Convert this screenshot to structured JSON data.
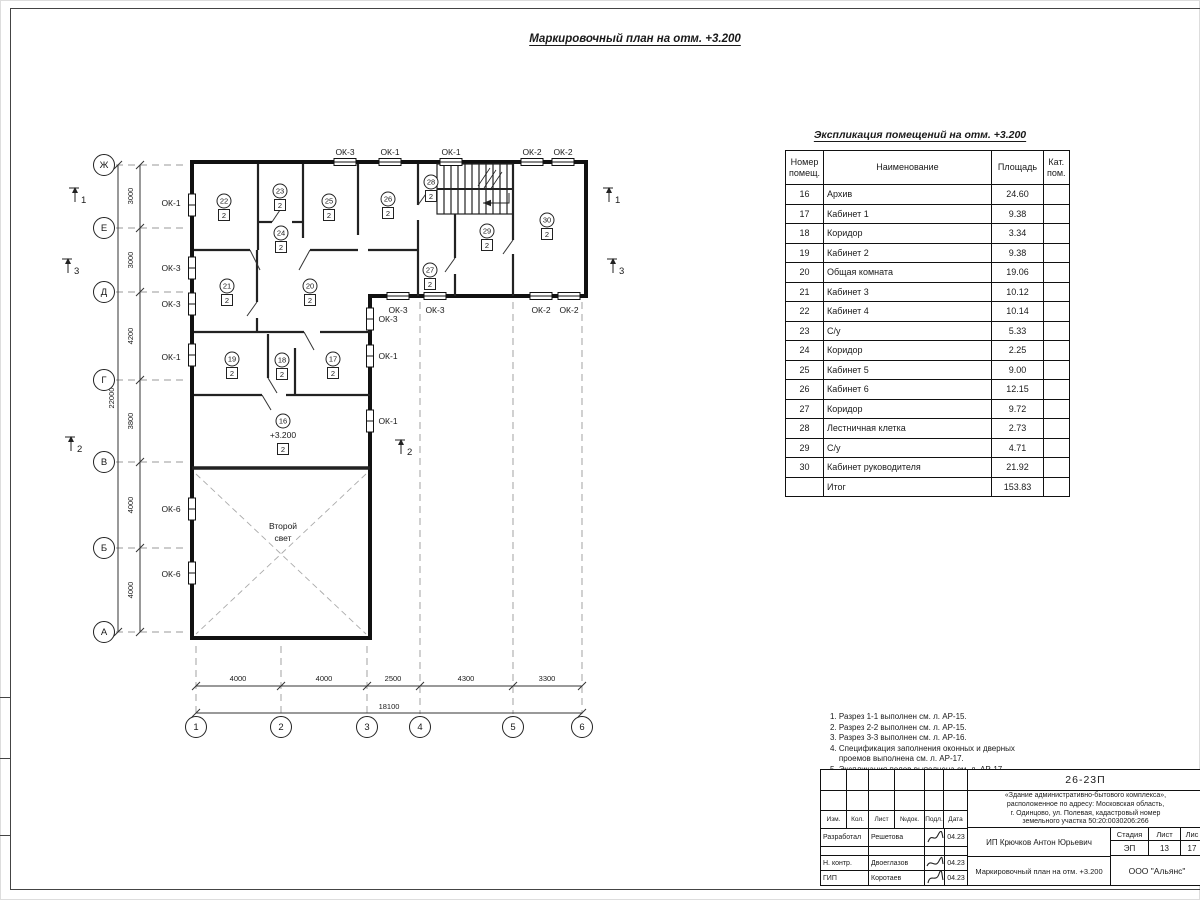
{
  "page": {
    "plan_title": "Маркировочный план на отм. +3.200",
    "table_title": "Экспликация помещений на отм. +3.200"
  },
  "explication": {
    "headers": [
      "Номер помещ.",
      "Наименование",
      "Площадь",
      "Кат. пом."
    ],
    "rows": [
      {
        "num": "16",
        "name": "Архив",
        "area": "24.60",
        "cat": ""
      },
      {
        "num": "17",
        "name": "Кабинет 1",
        "area": "9.38",
        "cat": ""
      },
      {
        "num": "18",
        "name": "Коридор",
        "area": "3.34",
        "cat": ""
      },
      {
        "num": "19",
        "name": "Кабинет 2",
        "area": "9.38",
        "cat": ""
      },
      {
        "num": "20",
        "name": "Общая комната",
        "area": "19.06",
        "cat": ""
      },
      {
        "num": "21",
        "name": "Кабинет 3",
        "area": "10.12",
        "cat": ""
      },
      {
        "num": "22",
        "name": "Кабинет 4",
        "area": "10.14",
        "cat": ""
      },
      {
        "num": "23",
        "name": "С/у",
        "area": "5.33",
        "cat": ""
      },
      {
        "num": "24",
        "name": "Коридор",
        "area": "2.25",
        "cat": ""
      },
      {
        "num": "25",
        "name": "Кабинет 5",
        "area": "9.00",
        "cat": ""
      },
      {
        "num": "26",
        "name": "Кабинет 6",
        "area": "12.15",
        "cat": ""
      },
      {
        "num": "27",
        "name": "Коридор",
        "area": "9.72",
        "cat": ""
      },
      {
        "num": "28",
        "name": "Лестничная клетка",
        "area": "2.73",
        "cat": ""
      },
      {
        "num": "29",
        "name": "С/у",
        "area": "4.71",
        "cat": ""
      },
      {
        "num": "30",
        "name": "Кабинет руководителя",
        "area": "21.92",
        "cat": ""
      }
    ],
    "total": {
      "num": "",
      "name": "Итог",
      "area": "153.83",
      "cat": ""
    }
  },
  "notes_lines": [
    "1. Разрез 1-1 выполнен см. л. АР-15.",
    "2. Разрез 2-2 выполнен см. л. АР-15.",
    "3. Разрез 3-3 выполнен см. л. АР-16.",
    "4. Спецификация заполнения оконных и дверных",
    "    проемов выполнена см. л. АР-17.",
    "5. Экспликация полов выполнена см. л. АР-17."
  ],
  "title_block": {
    "code": "26-23П",
    "desc_lines": [
      "«Здание административно-бытового комплекса»,",
      "расположенное по адресу: Московская область,",
      "г. Одинцово, ул. Полевая, кадастровый номер",
      "земельного участка 50:20:0030206:266"
    ],
    "sig_headers": [
      "Изм.",
      "Кол.",
      "Лист",
      "№док.",
      "Подл.",
      "Дата"
    ],
    "sig_rows": [
      {
        "role": "Разработал",
        "name": "Решетова",
        "date": "04.23"
      },
      {
        "role": "Н. контр.",
        "name": "Двоеглазов",
        "date": "04.23"
      },
      {
        "role": "ГИП",
        "name": "Коротаев",
        "date": "04.23"
      }
    ],
    "client": "ИП Крючков Антон Юрьевич",
    "stage_label": "Стадия",
    "sheet_label": "Лист",
    "sheets_label": "Лис",
    "stage": "ЭП",
    "sheet": "13",
    "sheets": "17",
    "doc_title": "Маркировочный план на отм. +3.200",
    "company": "ООО \"Альянс\""
  },
  "plan": {
    "axis_rows": [
      {
        "label": "Ж",
        "y": 165
      },
      {
        "label": "Е",
        "y": 228
      },
      {
        "label": "Д",
        "y": 292
      },
      {
        "label": "Г",
        "y": 380
      },
      {
        "label": "В",
        "y": 462
      },
      {
        "label": "Б",
        "y": 548
      },
      {
        "label": "А",
        "y": 632
      }
    ],
    "axis_cols": [
      {
        "label": "1",
        "x": 196
      },
      {
        "label": "2",
        "x": 281
      },
      {
        "label": "3",
        "x": 367
      },
      {
        "label": "4",
        "x": 420
      },
      {
        "label": "5",
        "x": 513
      },
      {
        "label": "6",
        "x": 582
      }
    ],
    "dims_left": [
      {
        "v": "3000",
        "y": 196
      },
      {
        "v": "3000",
        "y": 260
      },
      {
        "v": "4200",
        "y": 336
      },
      {
        "v": "3800",
        "y": 421
      },
      {
        "v": "4000",
        "y": 505
      },
      {
        "v": "4000",
        "y": 590
      }
    ],
    "total_left": "22000",
    "dims_bottom": [
      {
        "v": "4000",
        "x": 238
      },
      {
        "v": "4000",
        "x": 324
      },
      {
        "v": "2500",
        "x": 393
      },
      {
        "v": "4300",
        "x": 466
      },
      {
        "v": "3300",
        "x": 547
      }
    ],
    "total_bottom": "18100",
    "window_labels": [
      {
        "t": "ОК-3",
        "x": 345,
        "y": 155
      },
      {
        "t": "ОК-1",
        "x": 390,
        "y": 155
      },
      {
        "t": "ОК-1",
        "x": 451,
        "y": 155
      },
      {
        "t": "ОК-2",
        "x": 532,
        "y": 155
      },
      {
        "t": "ОК-2",
        "x": 563,
        "y": 155
      },
      {
        "t": "ОК-1",
        "x": 171,
        "y": 206
      },
      {
        "t": "ОК-3",
        "x": 171,
        "y": 271
      },
      {
        "t": "ОК-3",
        "x": 171,
        "y": 307
      },
      {
        "t": "ОК-1",
        "x": 171,
        "y": 360
      },
      {
        "t": "ОК-6",
        "x": 171,
        "y": 512
      },
      {
        "t": "ОК-6",
        "x": 171,
        "y": 577
      },
      {
        "t": "ОК-3",
        "x": 398,
        "y": 313
      },
      {
        "t": "ОК-3",
        "x": 435,
        "y": 313
      },
      {
        "t": "ОК-2",
        "x": 541,
        "y": 313
      },
      {
        "t": "ОК-2",
        "x": 569,
        "y": 313
      },
      {
        "t": "ОК-3",
        "x": 388,
        "y": 322
      },
      {
        "t": "ОК-1",
        "x": 388,
        "y": 359
      },
      {
        "t": "ОК-1",
        "x": 388,
        "y": 424
      }
    ],
    "rooms": [
      {
        "n": "16",
        "cat": "2",
        "x": 283,
        "y": 421,
        "elev": "+3.200"
      },
      {
        "n": "17",
        "cat": "2",
        "x": 333,
        "y": 359
      },
      {
        "n": "18",
        "cat": "2",
        "x": 282,
        "y": 360
      },
      {
        "n": "19",
        "cat": "2",
        "x": 232,
        "y": 359
      },
      {
        "n": "20",
        "cat": "2",
        "x": 310,
        "y": 286
      },
      {
        "n": "21",
        "cat": "2",
        "x": 227,
        "y": 286
      },
      {
        "n": "22",
        "cat": "2",
        "x": 224,
        "y": 201
      },
      {
        "n": "23",
        "cat": "2",
        "x": 280,
        "y": 191
      },
      {
        "n": "24",
        "cat": "2",
        "x": 281,
        "y": 233
      },
      {
        "n": "25",
        "cat": "2",
        "x": 329,
        "y": 201
      },
      {
        "n": "26",
        "cat": "2",
        "x": 388,
        "y": 199
      },
      {
        "n": "27",
        "cat": "2",
        "x": 430,
        "y": 270
      },
      {
        "n": "28",
        "cat": "2",
        "x": 431,
        "y": 182
      },
      {
        "n": "29",
        "cat": "2",
        "x": 487,
        "y": 231
      },
      {
        "n": "30",
        "cat": "2",
        "x": 547,
        "y": 220
      }
    ],
    "sections": [
      {
        "n": "1",
        "x": 78,
        "y": 197
      },
      {
        "n": "3",
        "x": 71,
        "y": 268
      },
      {
        "n": "2",
        "x": 74,
        "y": 446
      },
      {
        "n": "1",
        "x": 612,
        "y": 197
      },
      {
        "n": "3",
        "x": 616,
        "y": 268
      },
      {
        "n": "2",
        "x": 404,
        "y": 449
      }
    ],
    "texts": [
      {
        "t": "Второй",
        "x": 283,
        "y": 529
      },
      {
        "t": "свет",
        "x": 283,
        "y": 541
      }
    ]
  }
}
